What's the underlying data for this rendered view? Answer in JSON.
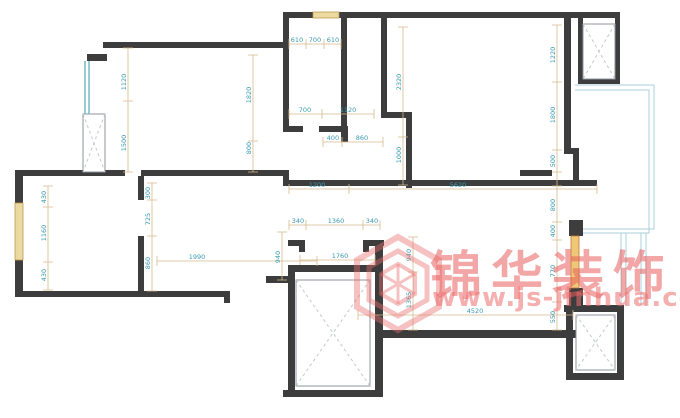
{
  "watermark": {
    "brand": "锦华装饰",
    "url": "www.js-jinhua.com"
  },
  "colors": {
    "wall": "#3d3d3d",
    "dimension_line": "#d8b98c",
    "dimension_text": "#3a9ab0",
    "window_teal": "#6fb7c4",
    "window_tan": "#ead9a0",
    "window_orange": "#eec878",
    "balcony_line": "#a8cfd8",
    "watermark_red": "#e85c5c"
  },
  "dimensions": [
    {
      "label": "610",
      "x": 297,
      "y": 42,
      "v": false
    },
    {
      "label": "700",
      "x": 315,
      "y": 42,
      "v": false
    },
    {
      "label": "610",
      "x": 333,
      "y": 42,
      "v": false
    },
    {
      "label": "700",
      "x": 305,
      "y": 112,
      "v": false
    },
    {
      "label": "1120",
      "x": 348,
      "y": 112,
      "v": false
    },
    {
      "label": "400",
      "x": 333,
      "y": 140,
      "v": false
    },
    {
      "label": "860",
      "x": 362,
      "y": 140,
      "v": false
    },
    {
      "label": "1200",
      "x": 317,
      "y": 187,
      "v": false
    },
    {
      "label": "5620",
      "x": 458,
      "y": 187,
      "v": false
    },
    {
      "label": "1990",
      "x": 197,
      "y": 259,
      "v": false
    },
    {
      "label": "340",
      "x": 298,
      "y": 223,
      "v": false
    },
    {
      "label": "1360",
      "x": 336,
      "y": 223,
      "v": false
    },
    {
      "label": "340",
      "x": 372,
      "y": 223,
      "v": false
    },
    {
      "label": "1760",
      "x": 340,
      "y": 258,
      "v": false
    },
    {
      "label": "4520",
      "x": 475,
      "y": 313,
      "v": false
    },
    {
      "label": "1120",
      "x": 126,
      "y": 82,
      "v": true
    },
    {
      "label": "1500",
      "x": 126,
      "y": 143,
      "v": true
    },
    {
      "label": "1820",
      "x": 251,
      "y": 95,
      "v": true
    },
    {
      "label": "800",
      "x": 251,
      "y": 148,
      "v": true
    },
    {
      "label": "2320",
      "x": 401,
      "y": 82,
      "v": true
    },
    {
      "label": "1000",
      "x": 401,
      "y": 155,
      "v": true
    },
    {
      "label": "1220",
      "x": 555,
      "y": 55,
      "v": true
    },
    {
      "label": "1800",
      "x": 555,
      "y": 115,
      "v": true
    },
    {
      "label": "500",
      "x": 555,
      "y": 161,
      "v": true
    },
    {
      "label": "800",
      "x": 555,
      "y": 205,
      "v": true
    },
    {
      "label": "400",
      "x": 555,
      "y": 231,
      "v": true
    },
    {
      "label": "770",
      "x": 555,
      "y": 271,
      "v": true
    },
    {
      "label": "550",
      "x": 555,
      "y": 317,
      "v": true
    },
    {
      "label": "430",
      "x": 46,
      "y": 197,
      "v": true
    },
    {
      "label": "1160",
      "x": 46,
      "y": 233,
      "v": true
    },
    {
      "label": "430",
      "x": 46,
      "y": 275,
      "v": true
    },
    {
      "label": "300",
      "x": 150,
      "y": 193,
      "v": true
    },
    {
      "label": "725",
      "x": 150,
      "y": 219,
      "v": true
    },
    {
      "label": "860",
      "x": 150,
      "y": 263,
      "v": true
    },
    {
      "label": "940",
      "x": 280,
      "y": 257,
      "v": true
    },
    {
      "label": "940",
      "x": 411,
      "y": 255,
      "v": true
    },
    {
      "label": "1365",
      "x": 411,
      "y": 300,
      "v": true
    }
  ]
}
